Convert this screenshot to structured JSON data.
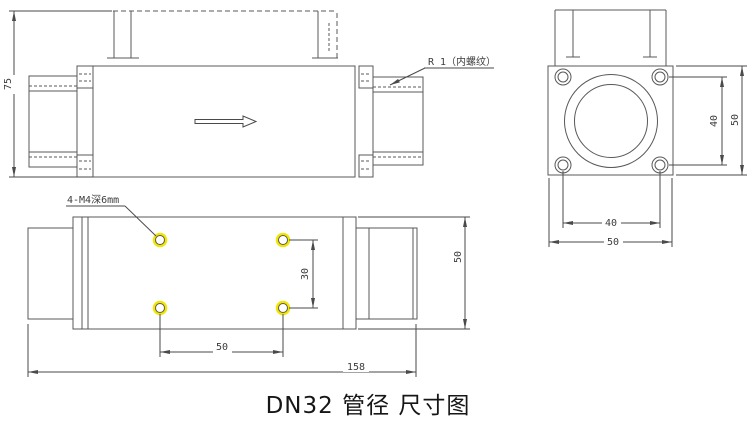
{
  "title": "DN32 管径 尺寸图",
  "colors": {
    "line_color": "#585858",
    "dimension_color": "#4a4a4a",
    "hole_highlight": "#f2e500",
    "background": "#ffffff"
  },
  "side_view": {
    "height": "75",
    "thread_label": "R 1（内螺纹）"
  },
  "end_view": {
    "hole_pitch_vertical": "40",
    "overall_height": "50",
    "hole_pitch_horizontal": "40",
    "overall_width": "50"
  },
  "top_view": {
    "tapped_hole_note": "4-M4深6mm",
    "hole_pitch_width": "30",
    "hole_pitch_length": "50",
    "overall_length": "158",
    "body_width": "50"
  }
}
